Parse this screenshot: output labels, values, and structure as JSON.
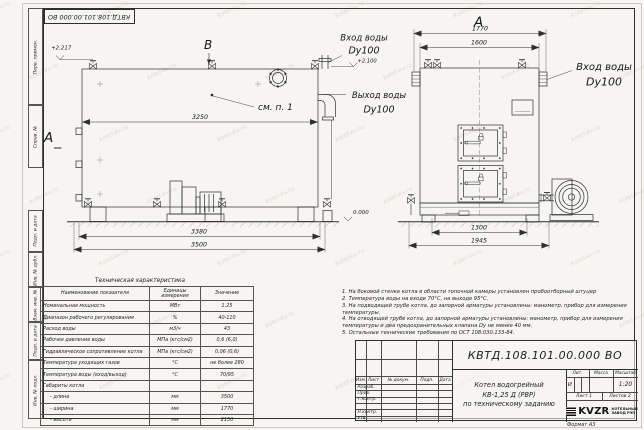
{
  "colors": {
    "paper": "#f6f5f1",
    "ink": "#2e2e2e"
  },
  "frame": {
    "corner_stamp": "КВТД.108.101.00.000 ВО",
    "strip_labels": [
      "Перв. примен.",
      "Справ. №",
      "Подп. и дата",
      "Инв. № дубл.",
      "Взам. инв. №",
      "Подп. и дата",
      "Инв. № подл."
    ],
    "format_note": "Формат А3"
  },
  "drawing": {
    "side": {
      "view_a": "А",
      "view_b": "В",
      "see_note": "см. п. 1",
      "dim_length_inner": "3250",
      "dim_length_mid": "3380",
      "dim_length_total": "3500",
      "elev_top": "+2.217",
      "elev_zero": "0.000",
      "inlet_title": "Вход воды",
      "inlet_dn": "Dy100",
      "inlet_elev": "+2.100",
      "outlet_title": "Выход воды",
      "outlet_dn": "Dy100"
    },
    "front": {
      "view_a": "А",
      "dim_width_total": "1770",
      "dim_width_inner": "1600",
      "dim_base": "1300",
      "dim_base_total": "1945",
      "inlet_title": "Вход воды",
      "inlet_dn": "Dy100"
    }
  },
  "spec_table": {
    "title": "Техническая характеристика",
    "headers": [
      "Наименование показателя",
      "Единицы измерения",
      "Значение"
    ],
    "rows": [
      [
        "Номинальная мощность",
        "МВт",
        "1,25"
      ],
      [
        "Диапазон рабочего регулирования",
        "%",
        "40-110"
      ],
      [
        "Расход воды",
        "м3/ч",
        "43"
      ],
      [
        "Рабочее давление воды",
        "МПа (кгс/см2)",
        "0,6 (6,0)"
      ],
      [
        "Гидравлическое сопротивление котла",
        "МПа (кгс/см2)",
        "0,06 (0,6)"
      ],
      [
        "Температура уходящих газов",
        "°С",
        "не более 280"
      ],
      [
        "Температура воды (вход/выход)",
        "°С",
        "70/95"
      ],
      [
        "Габариты котла",
        "",
        ""
      ],
      [
        "- длина",
        "мм",
        "3500"
      ],
      [
        "- ширина",
        "мм",
        "1770"
      ],
      [
        "- высота",
        "мм",
        "2150"
      ]
    ]
  },
  "notes": [
    "1. На боковой стенке котла в области топочной камеры установлен пробоотборный штуцер",
    "2. Температура воды на входе 70°С, на выходе 95°С.",
    "3. На подводящей трубе котла, до запорной арматуры установлены: манометр, прибор для измерения температуры.",
    "4. На отводящей трубе котла, до запорной арматуры установлены: манометр, прибор для измерения температуры и два предохранительных клапана Dy не менее 40 мм.",
    "5. Остальные технические требования по ОСТ 108.030.133-84."
  ],
  "title_block": {
    "doc_number": "КВТД.108.101.00.000 ВО",
    "rev_headers": [
      "Изм.",
      "Лист",
      "№ докум.",
      "Подп.",
      "Дата"
    ],
    "roles": [
      "Разраб.",
      "Пров.",
      "Т.контр.",
      "",
      "Н.контр.",
      "Утв."
    ],
    "product_line1": "Котел водогрейный",
    "product_line2": "КВ-1,25 Д (РВР)",
    "product_line3": "по техническому заданию",
    "lit_header": "Лит.",
    "mass_header": "Масса",
    "scale_header": "Масштаб",
    "lit_value": "И",
    "scale_value": "1:20",
    "sheet": "Лист 1",
    "sheets": "Листов 2",
    "logo_text": "KVZR",
    "company_line1": "КОТЕЛЬНЫЙ",
    "company_line2": "ЗАВОД РЭП"
  },
  "watermark": {
    "text": "kotel-kv.ru"
  }
}
